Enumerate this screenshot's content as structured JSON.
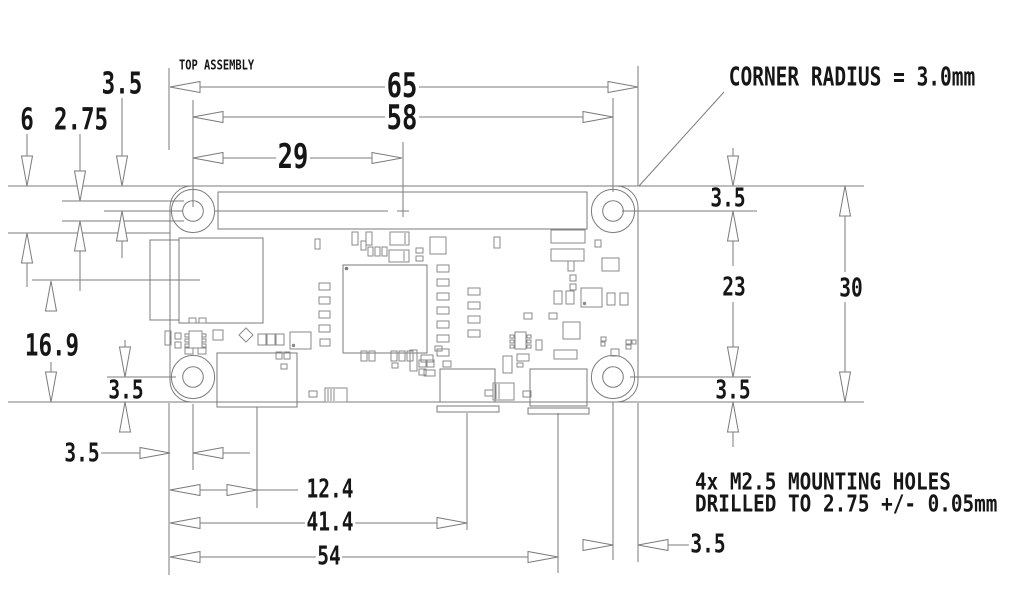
{
  "drawing": {
    "view_label": "TOP ASSEMBLY",
    "corner_note": "CORNER RADIUS = 3.0mm",
    "mounting_note_line1": "4x M2.5 MOUNTING HOLES",
    "mounting_note_line2": "DRILLED TO 2.75 +/- 0.05mm",
    "dims": {
      "board_width": "65",
      "hole_span_horizontal": "58",
      "hole_to_center_mark": "29",
      "hole_inset_top_left": "3.5",
      "pad_diameter": "6",
      "drill_diameter": "2.75",
      "sd_slot_centerline": "16.9",
      "hole_inset_bottom_left_v": "3.5",
      "hole_inset_left": "3.5",
      "hdmi_centerline": "12.4",
      "usb_data_centerline": "41.4",
      "usb_power_centerline": "54",
      "hole_inset_top_right": "3.5",
      "hole_span_vertical": "23",
      "board_height": "30",
      "hole_inset_bottom_right_v": "3.5",
      "hole_inset_right": "3.5"
    },
    "colors": {
      "line": "#7b7b7b",
      "text": "#161616",
      "background": "#ffffff"
    }
  }
}
